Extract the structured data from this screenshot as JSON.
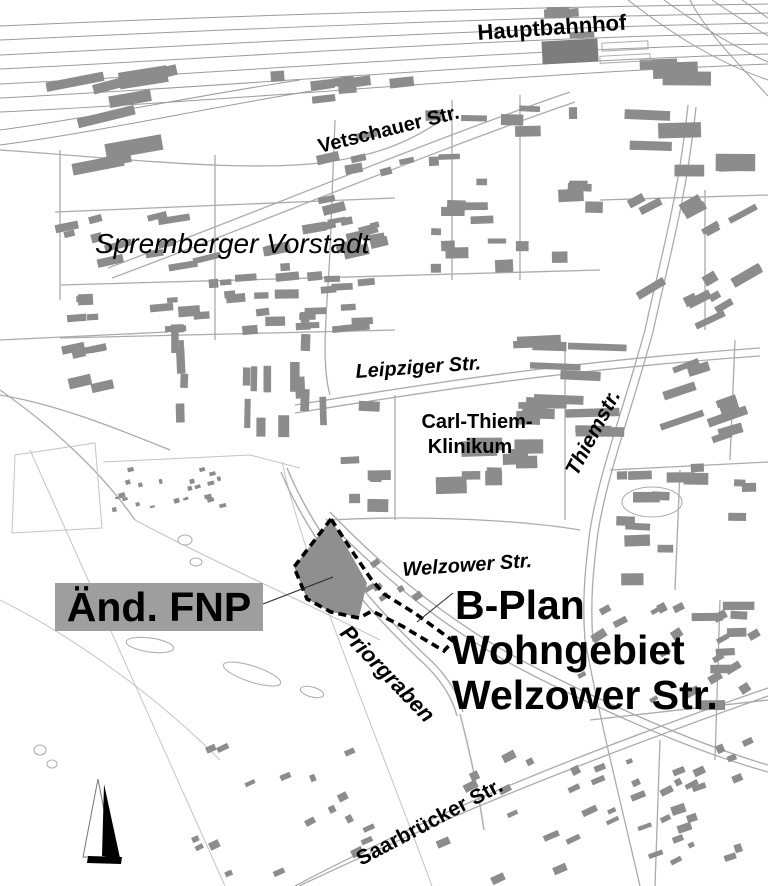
{
  "map": {
    "place_labels": {
      "hauptbahnhof": "Hauptbahnhof",
      "vetschauer_str": "Vetschauer Str.",
      "spremberger_vorstadt": "Spremberger Vorstadt",
      "leipziger_str": "Leipziger Str.",
      "carl_thiem_line1": "Carl-Thiem-",
      "carl_thiem_line2": "Klinikum",
      "thiemstr": "Thiemstr.",
      "welzower_str": "Welzower Str.",
      "priorgraben": "Priorgraben",
      "saarbruecker_str": "Saarbrücker Str."
    },
    "annotations": {
      "aend_fnp": "Änd. FNP",
      "bplan_line1": "B-Plan",
      "bplan_line2": "Wohngebiet",
      "bplan_line3": "Welzower Str."
    },
    "icons": {
      "north_arrow": "north-arrow-icon"
    },
    "colors": {
      "background": "#ffffff",
      "building": "#8c8c8c",
      "street_line": "#ababab",
      "rail_line": "#9b9b9b",
      "field_line": "#c4c4c4",
      "water_line": "#b0b0b0",
      "plan_area_fill": "#8f8f8f",
      "fnp_box_bg": "#9e9e9e",
      "boundary": "#000000",
      "label_text": "#000000"
    }
  }
}
